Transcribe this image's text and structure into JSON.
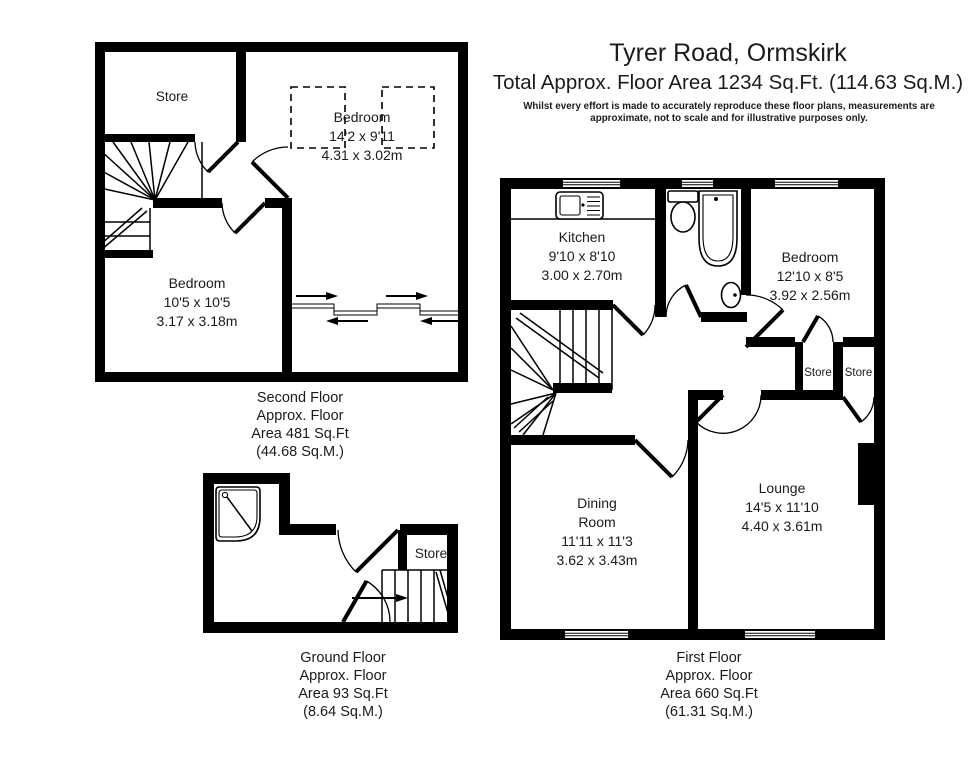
{
  "header": {
    "title": "Tyrer Road, Ormskirk",
    "subtitle": "Total Approx. Floor Area 1234 Sq.Ft. (114.63 Sq.M.)",
    "disclaimer1": "Whilst every effort is made to accurately reproduce these floor plans, measurements are",
    "disclaimer2": "approximate, not to scale and for illustrative purposes only."
  },
  "second_floor": {
    "store_label": "Store",
    "bedroom_rear": {
      "name": "Bedroom",
      "imperial": "14'2 x 9'11",
      "metric": "4.31 x 3.02m"
    },
    "bedroom_front": {
      "name": "Bedroom",
      "imperial": "10'5 x 10'5",
      "metric": "3.17 x 3.18m"
    },
    "caption": {
      "l1": "Second Floor",
      "l2": "Approx. Floor",
      "l3": "Area 481 Sq.Ft",
      "l4": "(44.68 Sq.M.)"
    }
  },
  "first_floor": {
    "kitchen": {
      "name": "Kitchen",
      "imperial": "9'10 x 8'10",
      "metric": "3.00 x 2.70m"
    },
    "bedroom": {
      "name": "Bedroom",
      "imperial": "12'10 x 8'5",
      "metric": "3.92 x 2.56m"
    },
    "store_left_label": "Store",
    "store_right_label": "Store",
    "dining": {
      "name1": "Dining",
      "name2": "Room",
      "imperial": "11'11 x 11'3",
      "metric": "3.62 x 3.43m"
    },
    "lounge": {
      "name": "Lounge",
      "imperial": "14'5 x 11'10",
      "metric": "4.40 x 3.61m"
    },
    "caption": {
      "l1": "First Floor",
      "l2": "Approx. Floor",
      "l3": "Area 660 Sq.Ft",
      "l4": "(61.31 Sq.M.)"
    }
  },
  "ground_floor": {
    "store_label": "Store",
    "caption": {
      "l1": "Ground Floor",
      "l2": "Approx. Floor",
      "l3": "Area 93 Sq.Ft",
      "l4": "(8.64 Sq.M.)"
    }
  },
  "colors": {
    "wall": "#000000",
    "background": "#ffffff",
    "text": "#1b1b1b"
  }
}
